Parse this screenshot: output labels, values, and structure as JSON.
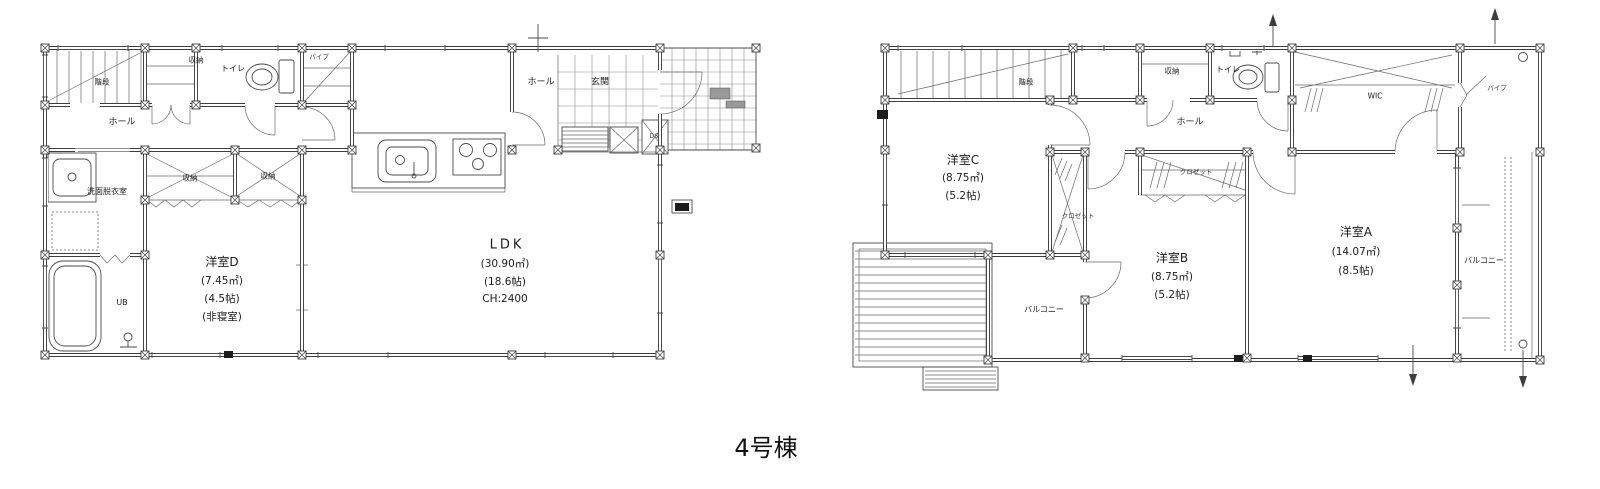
{
  "title": "4号棟",
  "floor1": {
    "labels": {
      "kaidan": "階段",
      "shuno_top": "収納",
      "toilet": "トイレ",
      "pipe": "パイプ",
      "hall_left": "ホール",
      "hall_entrance": "ホール",
      "genkan": "玄関",
      "ds": "DS",
      "senmen": "洗面脱衣室",
      "ub": "UB",
      "shuno_a": "収納",
      "shuno_b": "収納"
    },
    "rooms": {
      "yoshitsu_d": {
        "name": "洋室D",
        "area_m2": "(7.45㎡)",
        "area_jo": "(4.5帖)",
        "note": "(非寝室)"
      },
      "ldk": {
        "name": "LDK",
        "area_m2": "(30.90㎡)",
        "area_jo": "(18.6帖)",
        "ceiling_height": "CH:2400"
      }
    }
  },
  "floor2": {
    "labels": {
      "kaidan": "階段",
      "shuno": "収納",
      "hall": "ホール",
      "toilet": "トイレ",
      "wic": "WIC",
      "pipe": "パイプ",
      "closet_b": "クロゼット",
      "closet_c": "クロゼット",
      "balcony_left": "バルコニー",
      "balcony_right": "バルコニー"
    },
    "rooms": {
      "yoshitsu_c": {
        "name": "洋室C",
        "area_m2": "(8.75㎡)",
        "area_jo": "(5.2帖)"
      },
      "yoshitsu_b": {
        "name": "洋室B",
        "area_m2": "(8.75㎡)",
        "area_jo": "(5.2帖)"
      },
      "yoshitsu_a": {
        "name": "洋室A",
        "area_m2": "(14.07㎡)",
        "area_jo": "(8.5帖)"
      }
    }
  }
}
